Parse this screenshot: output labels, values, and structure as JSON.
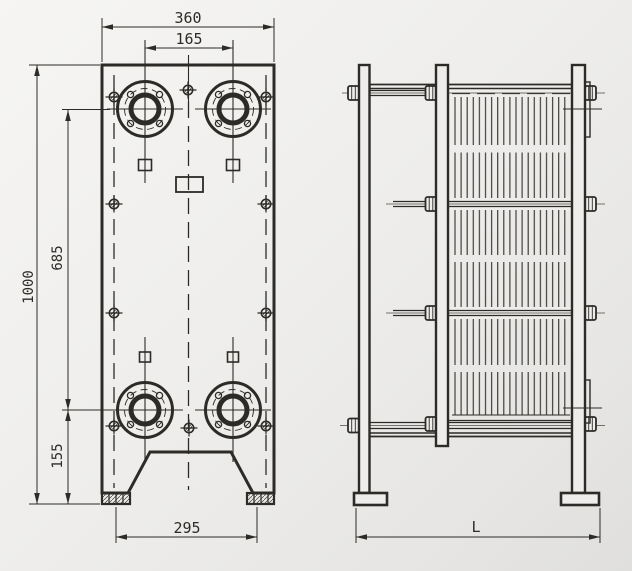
{
  "front_view": {
    "dims": {
      "top_width": "360",
      "port_spacing": "165",
      "height": "1000",
      "port_height": "685",
      "bottom_offset": "155",
      "foot_width": "295"
    }
  },
  "side_view": {
    "dims": {
      "length": "L"
    }
  },
  "colors": {
    "line": "#2d2b27",
    "line_thin": "#4a4844",
    "background": "#eeedeb"
  }
}
